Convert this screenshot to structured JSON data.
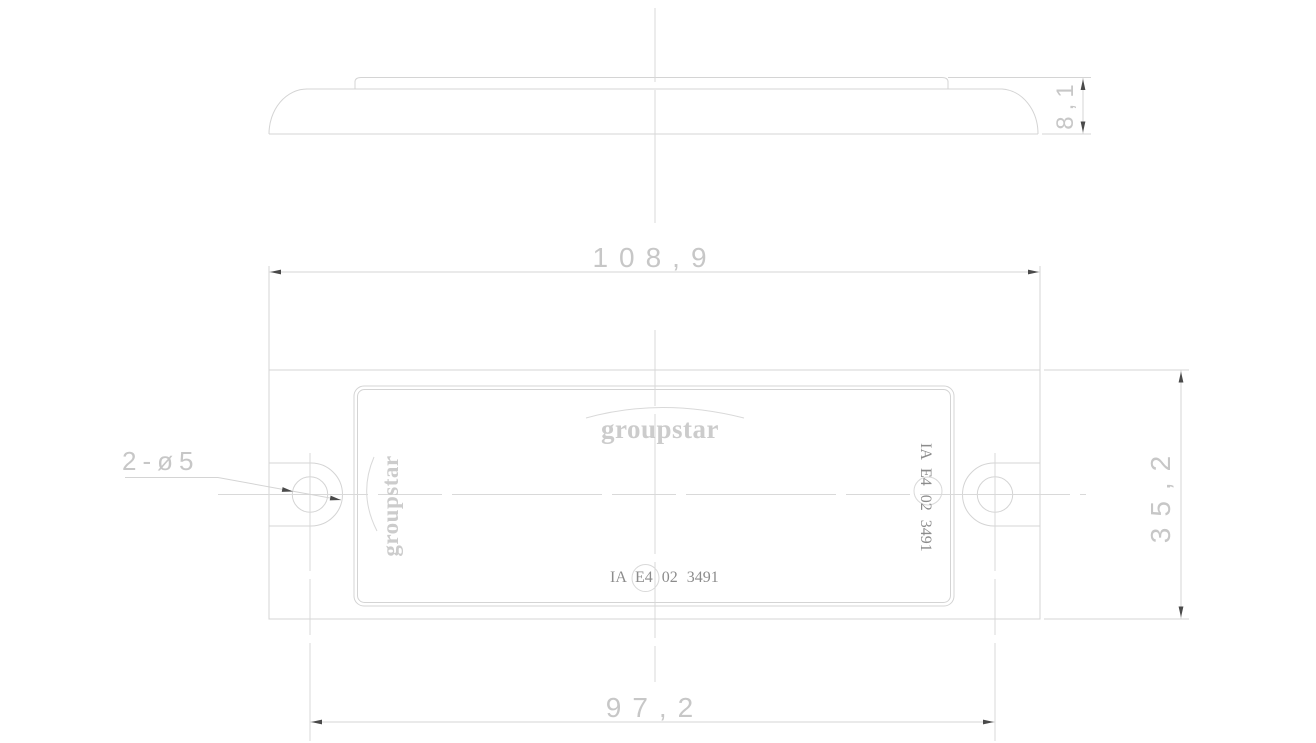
{
  "drawing": {
    "type": "technical-cad-drawing",
    "part": "rectangular reflector / lamp lens with two mounting ears",
    "colors": {
      "background": "#ffffff",
      "object_lines": "#d4d4d4",
      "centerlines": "#d9d9d9",
      "dimension_text": "#c7c7c7",
      "marking_text": "#8c8c8c",
      "logo_text": "#cccccc",
      "arrowheads": "#4a4a4a"
    },
    "side_view": {
      "height_dim": "8,1"
    },
    "front_view": {
      "width_dim": "108,9",
      "height_dim": "35,2",
      "hole_spacing_dim": "97,2",
      "hole_callout": "2-ø5",
      "hole_count": 2,
      "logo_top": "groupstar",
      "logo_side": "groupstar",
      "approval_bottom": "IA E4 02 3491",
      "approval_side": "IA E4 02 3491",
      "approval_circled_part": "E4"
    }
  }
}
